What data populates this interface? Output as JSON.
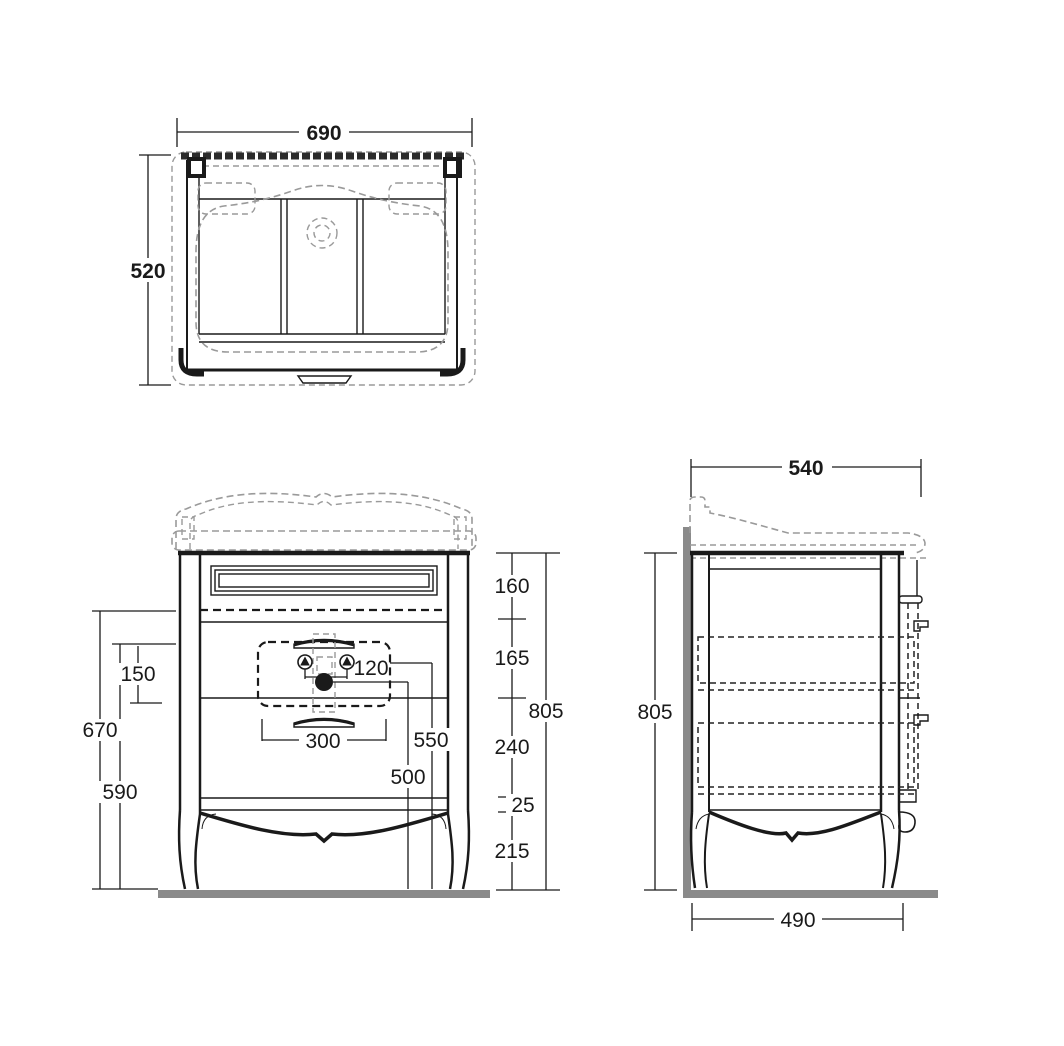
{
  "plan_view": {
    "width": "690",
    "depth": "520"
  },
  "front_view": {
    "total_height": "805",
    "seg_top_drawer": "160",
    "seg_middle": "165",
    "seg_lower": "240",
    "seg_rail": "25",
    "seg_legs": "215",
    "left_total": "670",
    "left_zone": "150",
    "left_lower": "590",
    "faucet_spacing": "120",
    "handle_width": "300",
    "supply_height": "550",
    "drain_height": "500"
  },
  "side_view": {
    "top_width": "540",
    "height": "805",
    "bottom_depth": "490"
  },
  "colors": {
    "line": "#1a1a1a",
    "dashed_gray": "#9a9a9a",
    "surface_gray": "#8a8a8a",
    "background": "#ffffff"
  }
}
